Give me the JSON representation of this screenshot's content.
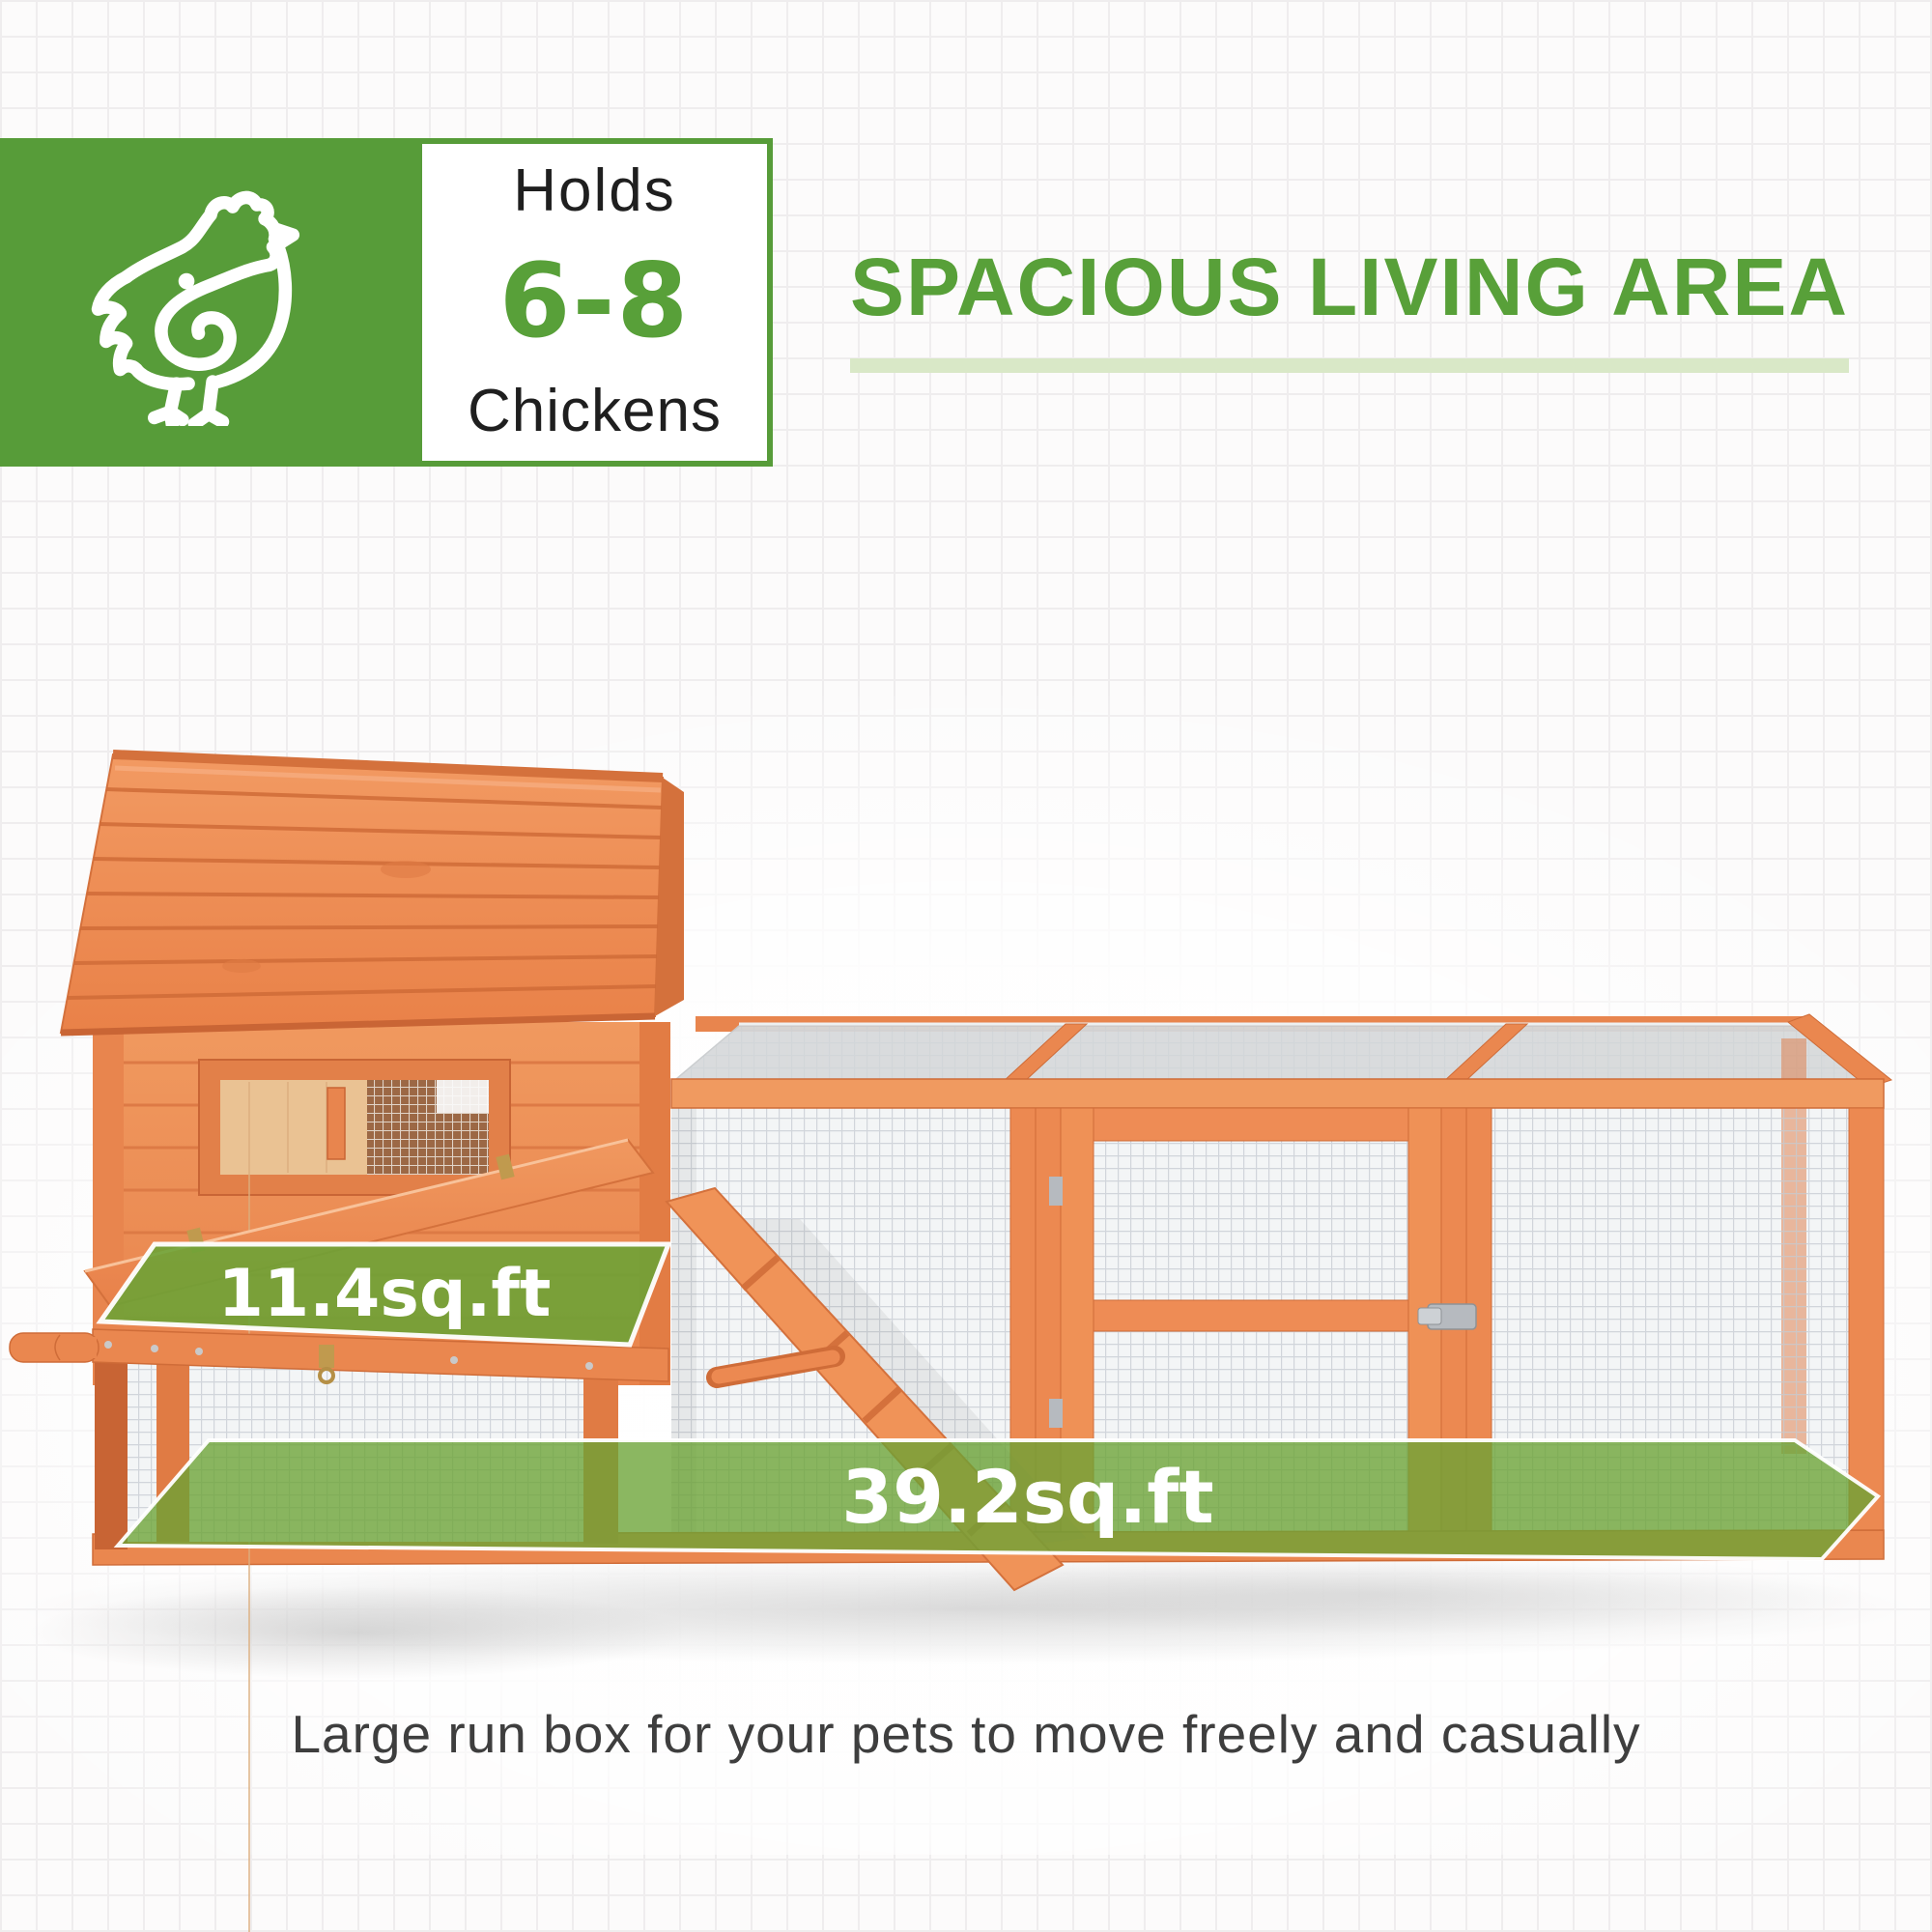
{
  "badge": {
    "icon": "chicken-icon",
    "holds_label": "Holds",
    "capacity": "6-8",
    "unit_label": "Chickens"
  },
  "headline": {
    "title": "SPACIOUS LIVING AREA"
  },
  "overlays": {
    "nesting_area": "11.4sq.ft",
    "run_area": "39.2sq.ft"
  },
  "caption": {
    "text": "Large run box for your pets to move freely and casually"
  },
  "colors": {
    "brand_green": "#579c39",
    "accent_green": "#58a039",
    "underline_green": "#d9e8c7",
    "overlay_green": "#6aa335",
    "wood_orange": "#ee8c55",
    "wood_dark": "#cf6c38",
    "mesh_gray": "#c6ccd2",
    "panel_gray": "#d7d9db",
    "text_dark": "#1f1f1f",
    "caption_gray": "#3e3e3e"
  }
}
